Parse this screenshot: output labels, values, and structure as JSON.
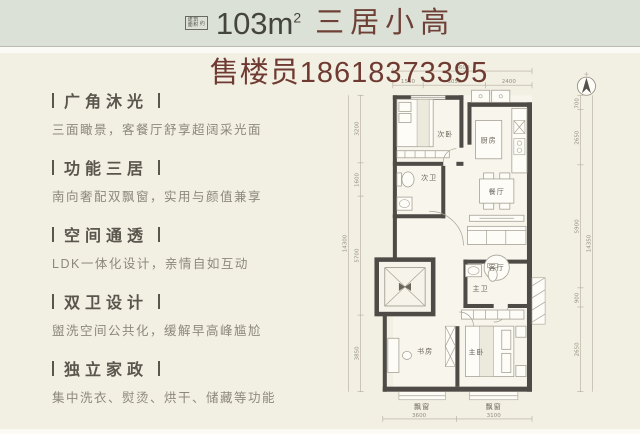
{
  "colors": {
    "page_bg": "#f2efe3",
    "header_bg": "#dce1d7",
    "title_red": "#6e4036",
    "phone_red": "#6f3a31",
    "wall": "#4e4b47"
  },
  "header": {
    "badge_line1": "建筑",
    "badge_line2": "面积",
    "badge_suffix": "约",
    "area": "103m",
    "area_sup": "2",
    "title": "三居小高"
  },
  "contact": {
    "phone_line": "售楼员18618373395"
  },
  "features": [
    {
      "title": "广角沐光",
      "desc": "三面瞰景，客餐厅舒享超阔采光面"
    },
    {
      "title": "功能三居",
      "desc": "南向奢配双飘窗，实用与颜值兼享"
    },
    {
      "title": "空间通透",
      "desc": "LDK一体化设计，亲情自如互动"
    },
    {
      "title": "双卫设计",
      "desc": "盥洗空间公共化，缓解早高峰尴尬"
    },
    {
      "title": "独立家政",
      "desc": "集中洗衣、熨烫、烘干、储藏等功能"
    }
  ],
  "floorplan": {
    "rooms": {
      "bedroom2": "次卧",
      "bath2": "次卫",
      "kitchen": "厨房",
      "dining": "餐厅",
      "living": "客厅",
      "master_bath": "主卫",
      "master": "主卧",
      "study": "书房",
      "bay_study": "飘窗",
      "bay_master": "飘窗"
    },
    "dims": {
      "top_total": "6600",
      "top_1": "1550",
      "top_2": "3050",
      "top_3": "2400",
      "left_total": "14300",
      "left_1": "3200",
      "left_2": "1600",
      "left_3": "5700",
      "left_4": "3850",
      "right_total": "14350",
      "right_1": "700",
      "right_2": "2650",
      "right_3": "5900",
      "right_4": "900",
      "right_5": "2650",
      "bottom_1": "3600",
      "bottom_2": "3100"
    }
  }
}
